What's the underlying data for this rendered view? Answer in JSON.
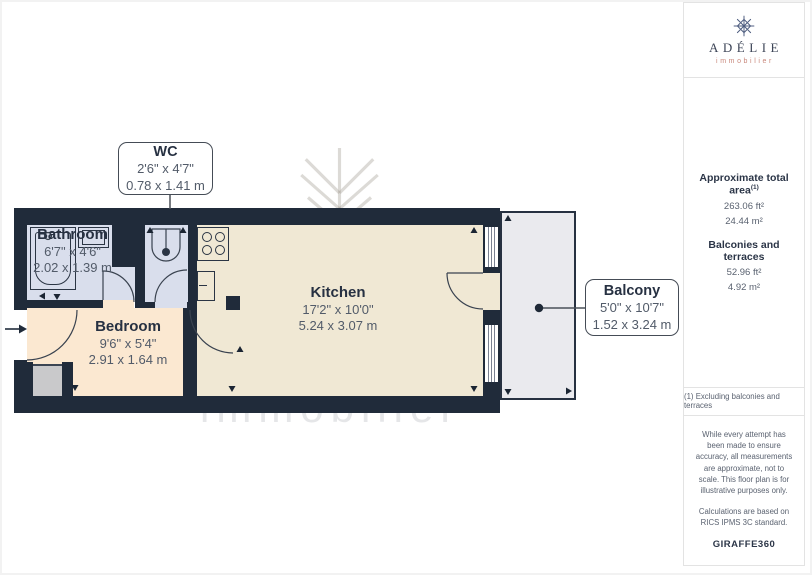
{
  "watermark": {
    "title": "ADÉLIE",
    "subtitle": "immobilier"
  },
  "rooms": [
    {
      "label": "Bathroom",
      "imperial": "6'7\" x 4'6\"",
      "metric": "2.02 x 1.39 m"
    },
    {
      "label": "Bedroom",
      "imperial": "9'6\" x 5'4\"",
      "metric": "2.91 x 1.64 m"
    },
    {
      "label": "Kitchen",
      "imperial": "17'2\" x 10'0\"",
      "metric": "5.24 x 3.07 m"
    }
  ],
  "callouts": [
    {
      "label": "WC",
      "imperial": "2'6\" x 4'7\"",
      "metric": "0.78 x 1.41 m"
    },
    {
      "label": "Balcony",
      "imperial": "5'0\" x 10'7\"",
      "metric": "1.52 x 3.24 m"
    }
  ],
  "sidebar": {
    "logo": {
      "name": "ADÉLIE",
      "tagline": "immobilier",
      "icon": "snowflake-icon"
    },
    "areas": {
      "total_label": "Approximate total area",
      "total_sup": "(1)",
      "total_ft": "263.06 ft²",
      "total_m": "24.44 m²",
      "balcony_label": "Balconies and terraces",
      "balcony_ft": "52.96 ft²",
      "balcony_m": "4.92 m²"
    },
    "note": "(1) Excluding balconies and terraces",
    "disclaimer_1": "While every attempt has been made to ensure accuracy, all measurements are approximate, not to scale. This floor plan is for illustrative purposes only.",
    "disclaimer_2": "Calculations are based on RICS IPMS 3C standard.",
    "brand": "GIRAFFE",
    "brand_suffix": "360"
  },
  "palette": {
    "wall": "#202b3a",
    "bath_floor": "#d9deec",
    "kitchen_floor": "#f0e8d4",
    "bedroom_floor": "#fbe8d1",
    "balcony_floor": "#eaeaee",
    "accent_coral": "#c8877b"
  }
}
